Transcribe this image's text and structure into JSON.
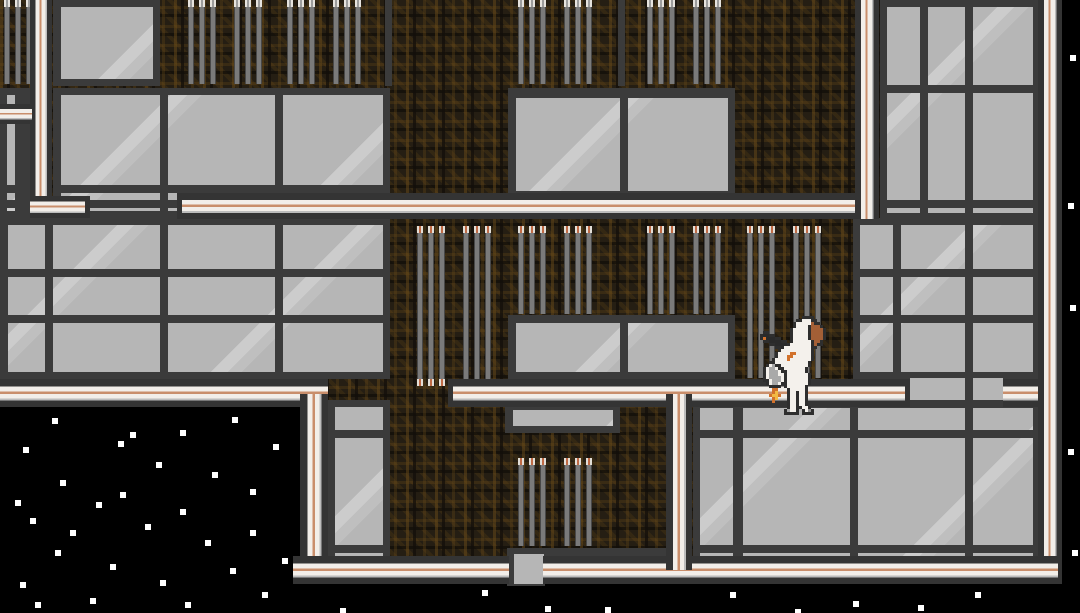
{
  "scene": {
    "width": 1080,
    "height": 613,
    "grid": {
      "pitch": 115,
      "line": 8,
      "origin_x": 45,
      "origin_y": 85
    },
    "colors": {
      "space_black": "#000000",
      "rock_brown": "#251e13",
      "rock_speckle": "#5f451a",
      "tile_grey": "#b6b6b6",
      "grout_dark": "#3b3b3b",
      "conduit_white": "#f2eee9",
      "conduit_orange": "#c98e6b",
      "pipe_grey": "#7a7a7a",
      "star_white": "#ffffff"
    },
    "rock": {
      "x": 0,
      "y": 0,
      "w": 1063,
      "h": 587
    },
    "space": [
      {
        "x": 0,
        "y": 400,
        "w": 302,
        "h": 213
      },
      {
        "x": 0,
        "y": 584,
        "w": 1080,
        "h": 29
      },
      {
        "x": 1062,
        "y": 0,
        "w": 18,
        "h": 613
      }
    ],
    "bars": [
      {
        "x": 385,
        "y": 0,
        "w": 7,
        "h": 86
      },
      {
        "x": 618,
        "y": 0,
        "w": 7,
        "h": 86
      },
      {
        "x": 620,
        "y": 548,
        "w": 8,
        "h": 16
      }
    ],
    "tiles": [
      {
        "x": 53,
        "y": 0,
        "w": 107,
        "h": 86
      },
      {
        "x": 880,
        "y": 0,
        "w": 160,
        "h": 220
      },
      {
        "x": 0,
        "y": 88,
        "w": 30,
        "h": 130
      },
      {
        "x": 53,
        "y": 88,
        "w": 337,
        "h": 130
      },
      {
        "x": 508,
        "y": 88,
        "w": 227,
        "h": 110
      },
      {
        "x": 0,
        "y": 218,
        "w": 390,
        "h": 161
      },
      {
        "x": 508,
        "y": 315,
        "w": 227,
        "h": 64
      },
      {
        "x": 853,
        "y": 218,
        "w": 187,
        "h": 161
      },
      {
        "x": 910,
        "y": 376,
        "w": 93,
        "h": 30,
        "noframe": true
      },
      {
        "x": 327,
        "y": 400,
        "w": 63,
        "h": 163
      },
      {
        "x": 505,
        "y": 403,
        "w": 115,
        "h": 30
      },
      {
        "x": 693,
        "y": 401,
        "w": 347,
        "h": 162
      },
      {
        "x": 507,
        "y": 548,
        "w": 113,
        "h": 16,
        "noframe": true
      },
      {
        "x": 507,
        "y": 548,
        "w": 38,
        "h": 38,
        "noframe": true
      },
      {
        "x": 628,
        "y": 548,
        "w": 40,
        "h": 16,
        "noframe": true
      }
    ],
    "pipes": [
      {
        "x": 4,
        "y": 0,
        "h": 84,
        "cap": "grey"
      },
      {
        "x": 188,
        "y": 0,
        "h": 84,
        "cap": "grey"
      },
      {
        "x": 234,
        "y": 0,
        "h": 84,
        "cap": "grey"
      },
      {
        "x": 287,
        "y": 0,
        "h": 84,
        "cap": "grey"
      },
      {
        "x": 333,
        "y": 0,
        "h": 84,
        "cap": "grey"
      },
      {
        "x": 518,
        "y": 0,
        "h": 84,
        "cap": "grey"
      },
      {
        "x": 564,
        "y": 0,
        "h": 84,
        "cap": "grey"
      },
      {
        "x": 647,
        "y": 0,
        "h": 84,
        "cap": "grey"
      },
      {
        "x": 693,
        "y": 0,
        "h": 84,
        "cap": "grey"
      },
      {
        "x": 417,
        "y": 226,
        "h": 160,
        "cap": "orange",
        "bottom": true
      },
      {
        "x": 463,
        "y": 226,
        "h": 160,
        "cap": "orange",
        "bottom": true
      },
      {
        "x": 518,
        "y": 226,
        "h": 88,
        "cap": "orange"
      },
      {
        "x": 564,
        "y": 226,
        "h": 88,
        "cap": "orange"
      },
      {
        "x": 647,
        "y": 226,
        "h": 88,
        "cap": "orange"
      },
      {
        "x": 693,
        "y": 226,
        "h": 88,
        "cap": "orange"
      },
      {
        "x": 747,
        "y": 226,
        "h": 152,
        "cap": "orange"
      },
      {
        "x": 793,
        "y": 226,
        "h": 152,
        "cap": "orange"
      },
      {
        "x": 518,
        "y": 458,
        "h": 88,
        "cap": "orange"
      },
      {
        "x": 564,
        "y": 458,
        "h": 88,
        "cap": "orange"
      }
    ],
    "conduits": [
      {
        "x": 30,
        "y": 0,
        "w": 22,
        "h": 218,
        "dir": "v",
        "caps": []
      },
      {
        "x": 30,
        "y": 196,
        "w": 60,
        "h": 22,
        "dir": "h",
        "caps": [
          "right"
        ]
      },
      {
        "x": 0,
        "y": 104,
        "w": 32,
        "h": 20,
        "dir": "h",
        "caps": []
      },
      {
        "x": 177,
        "y": 193,
        "w": 680,
        "h": 26,
        "dir": "h",
        "caps": [
          "left"
        ]
      },
      {
        "x": 855,
        "y": 0,
        "w": 24,
        "h": 219,
        "dir": "v",
        "caps": []
      },
      {
        "x": 448,
        "y": 379,
        "w": 462,
        "h": 28,
        "dir": "h",
        "caps": [
          "left",
          "right"
        ]
      },
      {
        "x": 1003,
        "y": 379,
        "w": 52,
        "h": 28,
        "dir": "h",
        "caps": []
      },
      {
        "x": 1038,
        "y": 0,
        "w": 24,
        "h": 584,
        "dir": "v",
        "caps": []
      },
      {
        "x": 0,
        "y": 379,
        "w": 328,
        "h": 28,
        "dir": "h",
        "caps": []
      },
      {
        "x": 300,
        "y": 394,
        "w": 28,
        "h": 184,
        "dir": "v",
        "caps": []
      },
      {
        "x": 293,
        "y": 556,
        "w": 216,
        "h": 28,
        "dir": "h",
        "caps": []
      },
      {
        "x": 543,
        "y": 556,
        "w": 515,
        "h": 28,
        "dir": "h",
        "caps": []
      },
      {
        "x": 666,
        "y": 394,
        "w": 26,
        "h": 176,
        "dir": "v",
        "caps": []
      }
    ],
    "stars": [
      {
        "x": 52,
        "y": 418
      },
      {
        "x": 118,
        "y": 441
      },
      {
        "x": 180,
        "y": 430
      },
      {
        "x": 232,
        "y": 417
      },
      {
        "x": 23,
        "y": 447
      },
      {
        "x": 130,
        "y": 432
      },
      {
        "x": 156,
        "y": 462
      },
      {
        "x": 273,
        "y": 444
      },
      {
        "x": 60,
        "y": 480
      },
      {
        "x": 212,
        "y": 472
      },
      {
        "x": 120,
        "y": 492
      },
      {
        "x": 15,
        "y": 500
      },
      {
        "x": 96,
        "y": 502
      },
      {
        "x": 30,
        "y": 518
      },
      {
        "x": 180,
        "y": 509
      },
      {
        "x": 250,
        "y": 489
      },
      {
        "x": 145,
        "y": 524
      },
      {
        "x": 70,
        "y": 530
      },
      {
        "x": 250,
        "y": 530
      },
      {
        "x": 205,
        "y": 540
      },
      {
        "x": 55,
        "y": 550
      },
      {
        "x": 110,
        "y": 564
      },
      {
        "x": 20,
        "y": 582
      },
      {
        "x": 160,
        "y": 580
      },
      {
        "x": 230,
        "y": 568
      },
      {
        "x": 282,
        "y": 558
      },
      {
        "x": 90,
        "y": 598
      },
      {
        "x": 35,
        "y": 602
      },
      {
        "x": 185,
        "y": 602
      },
      {
        "x": 262,
        "y": 592
      },
      {
        "x": 340,
        "y": 608
      },
      {
        "x": 482,
        "y": 590
      },
      {
        "x": 545,
        "y": 606
      },
      {
        "x": 605,
        "y": 607
      },
      {
        "x": 730,
        "y": 592
      },
      {
        "x": 795,
        "y": 609
      },
      {
        "x": 853,
        "y": 601
      },
      {
        "x": 918,
        "y": 605
      },
      {
        "x": 975,
        "y": 592
      },
      {
        "x": 1070,
        "y": 55
      },
      {
        "x": 1068,
        "y": 203
      },
      {
        "x": 1070,
        "y": 305
      },
      {
        "x": 1068,
        "y": 449
      },
      {
        "x": 1072,
        "y": 550
      }
    ],
    "sprite": {
      "x": 760,
      "y": 316,
      "scale": 3,
      "palette": {
        "o": "#2e2e2e",
        "w": "#f4f1ec",
        "b": "#a35f36",
        "O": "#d2722c",
        "y": "#f2b945",
        "g": "#a9a9a9",
        "k": "#2a2a2a",
        "G": "#8e8e8e"
      },
      "rows": [
        "..............oooo......",
        "............oowwwoo.....",
        "...........owwwwwboo....",
        "...........owwwwobbbo...",
        "..........owwwwwobbbbo..",
        ".oo.......owwwwwobbbbo..",
        "okkoo.....owwwwwobbbbo..",
        "oOkkkoo...owwwwwobbbbo..",
        ".ookkkkoo.owwwwwwobbo...",
        "...ookkkkowwwwwwwoboo...",
        ".....ookwwwwwwwwwoo.....",
        "......owwwwwwwwwwo......",
        ".....owwwwOOwwwwwo......",
        ".....owwwOOwwwwwwo......",
        "....owwwwOwwwwwwwo......",
        "...oowwwwwwwwwwwo.......",
        "..owgoowwwwwwwwwo.......",
        ".owggwoowwwwwwwo........",
        ".owgggwoowwwwwwo........",
        ".owgggwwowwwwwwwo.......",
        ".owggggwowwwwwwwo.......",
        ".oowgggwowwwwwwwo.......",
        "..owggwoowwwwwwwo.......",
        "...oooo.owwwwwwo........",
        "....OO...owwwwwo........",
        "....Oy...owwowwo........",
        "...OyyO..owwowwo........",
        "....Oy...owwowwo........",
        "....O....owwowwo........",
        ".........owwowwo........",
        ".........owwoowwo.......",
        "........ogwwo.owGo......",
        "........ooooo.oooo......"
      ]
    }
  }
}
